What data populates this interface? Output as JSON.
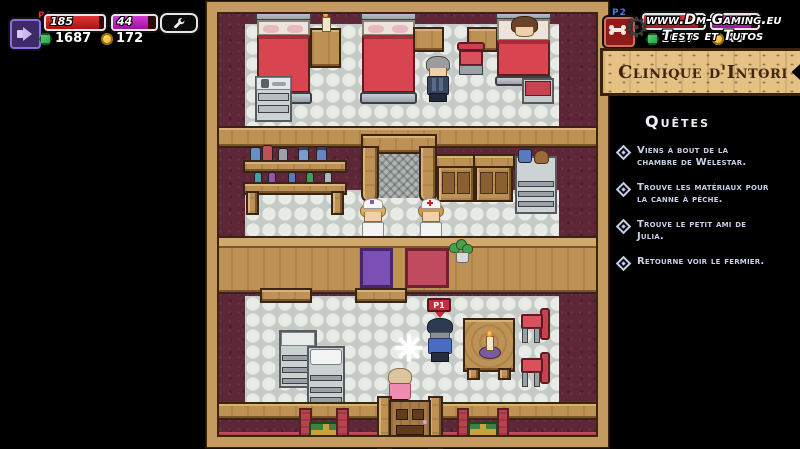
{
  "hud": {
    "p1": {
      "tag": "P1",
      "health": "185",
      "mana": "44",
      "gems": "1687",
      "coins": "172"
    },
    "p2": {
      "tag": "P2",
      "gems": "1687",
      "coins": "40"
    }
  },
  "watermark": {
    "line1": "www.Dm-Gaming.eu",
    "line2": "Tests et Tutos"
  },
  "sign": {
    "title": "Clinique d'Intori"
  },
  "quest_panel": {
    "title": "Quêtes",
    "items": [
      "Viens à bout de la chambre de Welestar.",
      "Trouve les matériaux pour la canne à pêche.",
      "Trouve le petit ami de Julia.",
      "Retourne voir le fermier."
    ]
  },
  "player": {
    "overhead_tag": "P1"
  },
  "icons": {
    "p1_badge": "megaphone-icon",
    "p2_badge": "bone-icon",
    "settings": "wrench-icon",
    "currency_primary": "gem-icon",
    "currency_secondary": "coin-icon",
    "watermark_logo": "gear-icon",
    "quest_bullet": "diamond-bullet"
  },
  "colors": {
    "health_bar": "#cc1f24",
    "mana_bar": "#c428c4",
    "quest_text": "#c6d0e6",
    "sign_bg": "#e6c184",
    "sign_text": "#40240e",
    "wall": "#5e2737",
    "wood": "#c49a5f",
    "tile": "#e9ebe7",
    "bed_blanket": "#d84550",
    "counter_purple": "#7a50b4",
    "counter_red": "#c04a5e"
  }
}
